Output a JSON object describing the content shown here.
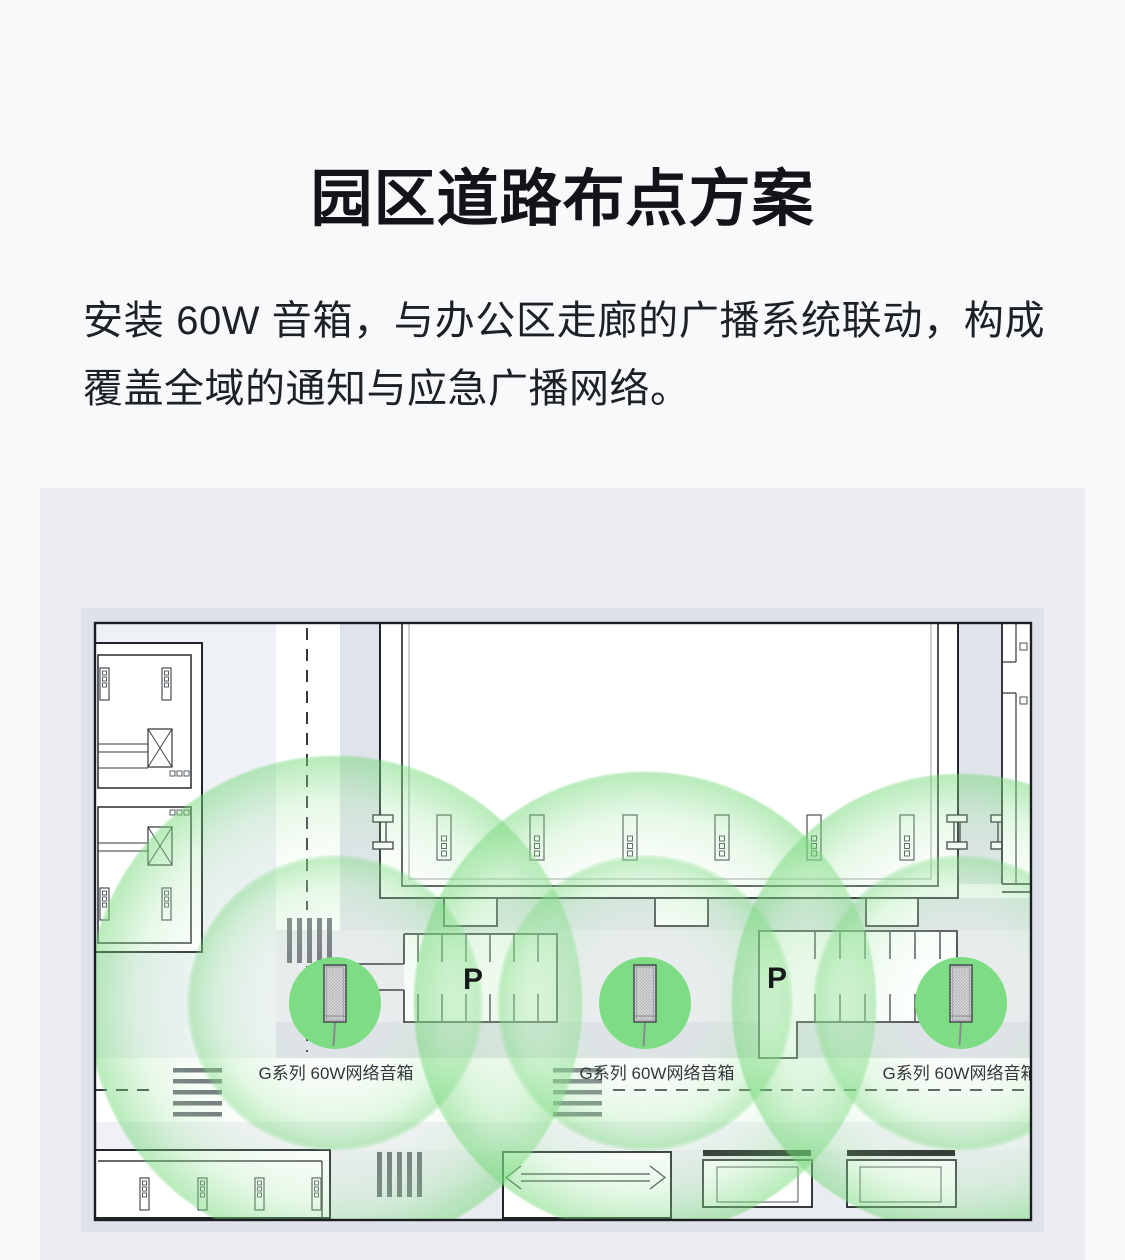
{
  "page": {
    "background": "#f8f9fb"
  },
  "header": {
    "title": "园区道路布点方案"
  },
  "description": {
    "text": "安装 60W 音箱，与办公区走廊的广播系统联动，构成覆盖全域的通知与应急广播网络。"
  },
  "diagram": {
    "panel_bg": "#ecedf2",
    "canvas_bg": "#dfe2ea",
    "map_ink": "#212529",
    "accent_green": "#7edd84",
    "coverage_green": "#6ed573",
    "parking_labels": [
      "P",
      "P"
    ],
    "speakers": [
      {
        "label": "G系列 60W网络音箱"
      },
      {
        "label": "G系列 60W网络音箱"
      },
      {
        "label": "G系列 60W网络音箱"
      }
    ]
  }
}
